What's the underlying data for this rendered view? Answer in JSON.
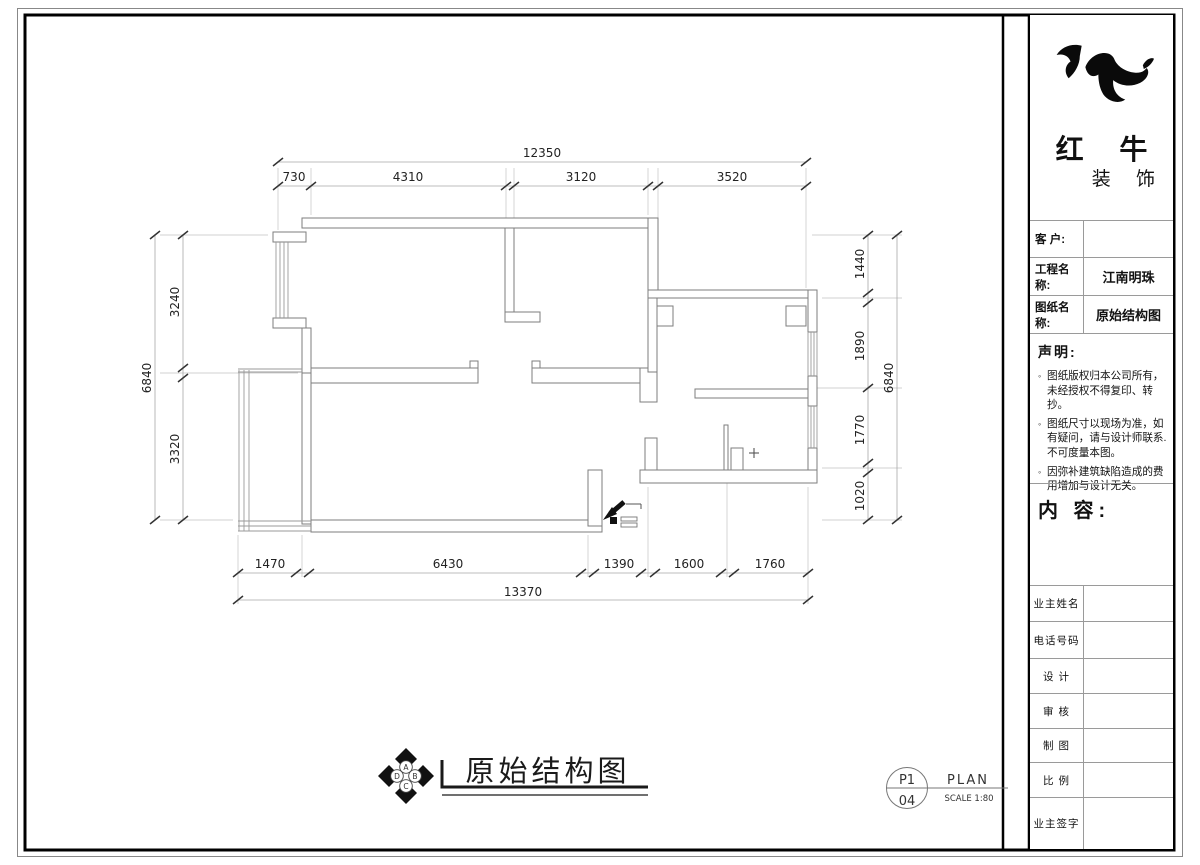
{
  "drawing": {
    "title": "原始结构图",
    "sheet_ref": {
      "page_top": "P1",
      "page_bottom": "04",
      "type_label": "PLAN",
      "scale_label": "SCALE 1:80"
    },
    "compass": {
      "a": "A",
      "b": "B",
      "c": "C",
      "d": "D"
    },
    "icons": {
      "entry": "entry-door-symbol",
      "drain": "drain-cross-symbol",
      "compass": "compass-rosette"
    },
    "dimensions": {
      "top_total": "12350",
      "top_segments": [
        "730",
        "4310",
        "3120",
        "3520"
      ],
      "bottom_total": "13370",
      "bottom_segments": [
        "1470",
        "6430",
        "1390",
        "1600",
        "1760"
      ],
      "left_total": "6840",
      "left_segments": [
        "3240",
        "3320"
      ],
      "right_total": "6840",
      "right_segments": [
        "1440",
        "1890",
        "1770",
        "1020"
      ]
    }
  },
  "title_block": {
    "brand": {
      "name_top": "红 牛",
      "name_bottom": "装 饰",
      "logo_icon": "bull-swoosh-logo"
    },
    "fields": [
      {
        "label": "客  户:",
        "value": ""
      },
      {
        "label": "工程名称:",
        "value": "江南明珠"
      },
      {
        "label": "图纸名称:",
        "value": "原始结构图"
      }
    ],
    "statement": {
      "heading": "声明:",
      "bullet": "◦",
      "items": [
        "图纸版权归本公司所有，未经授权不得复印、转抄。",
        "图纸尺寸以现场为准，如有疑问，请与设计师联系.不可度量本图。",
        "因弥补建筑缺陷造成的费用增加与设计无关。"
      ]
    },
    "content_label": "内 容:",
    "signature_rows": [
      "业主姓名",
      "电话号码",
      "设 计",
      "审 核",
      "制 图",
      "比 例",
      "业主签字"
    ]
  }
}
